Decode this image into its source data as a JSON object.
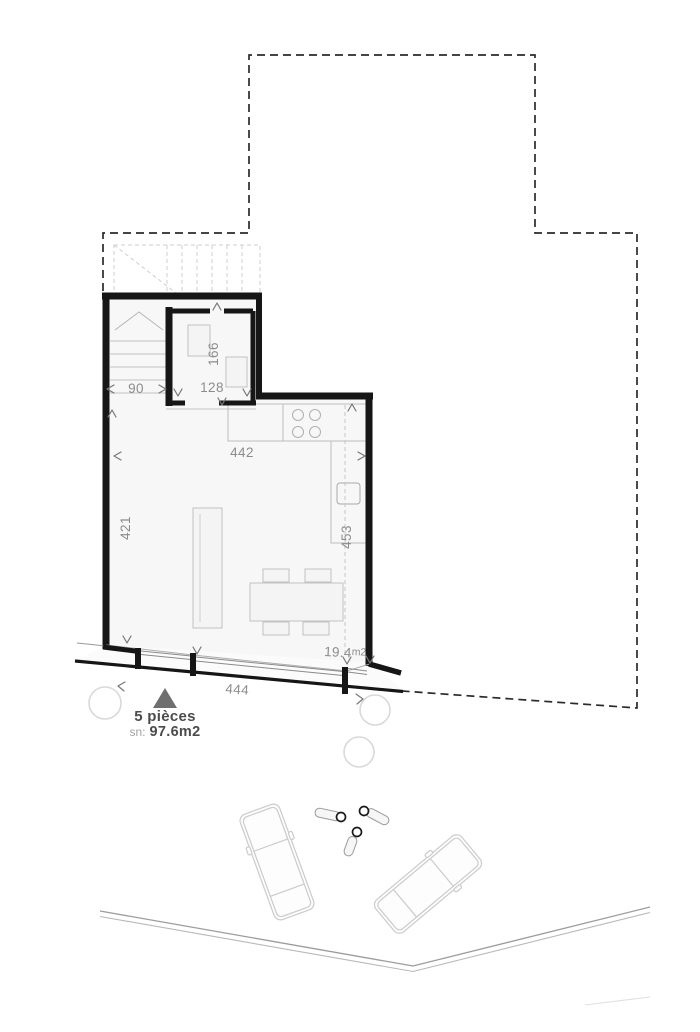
{
  "plan_type": "floor-plan",
  "colors": {
    "wall": "#161616",
    "parcel_boundary": "#2b2b2b",
    "dimension_text": "#8c8c8c",
    "annotation_dark": "#4c4c4c",
    "annotation_light": "#a3a3a3",
    "marker_triangle": "#6f6f6f",
    "furniture_line": "#c2c2c2",
    "floor_fill": "#f7f7f7"
  },
  "dimensions": {
    "stair_width": "90",
    "upper_room_width": "128",
    "upper_room_depth": "166",
    "living_width": "442",
    "living_depth_left": "421",
    "living_depth_right": "453",
    "front_window_width": "444"
  },
  "areas": {
    "terrace_value": "19.4",
    "terrace_unit": "m2"
  },
  "annotation": {
    "rooms_label": "5 pièces",
    "surface_prefix": "sn:",
    "surface_value": "97.6m2"
  }
}
